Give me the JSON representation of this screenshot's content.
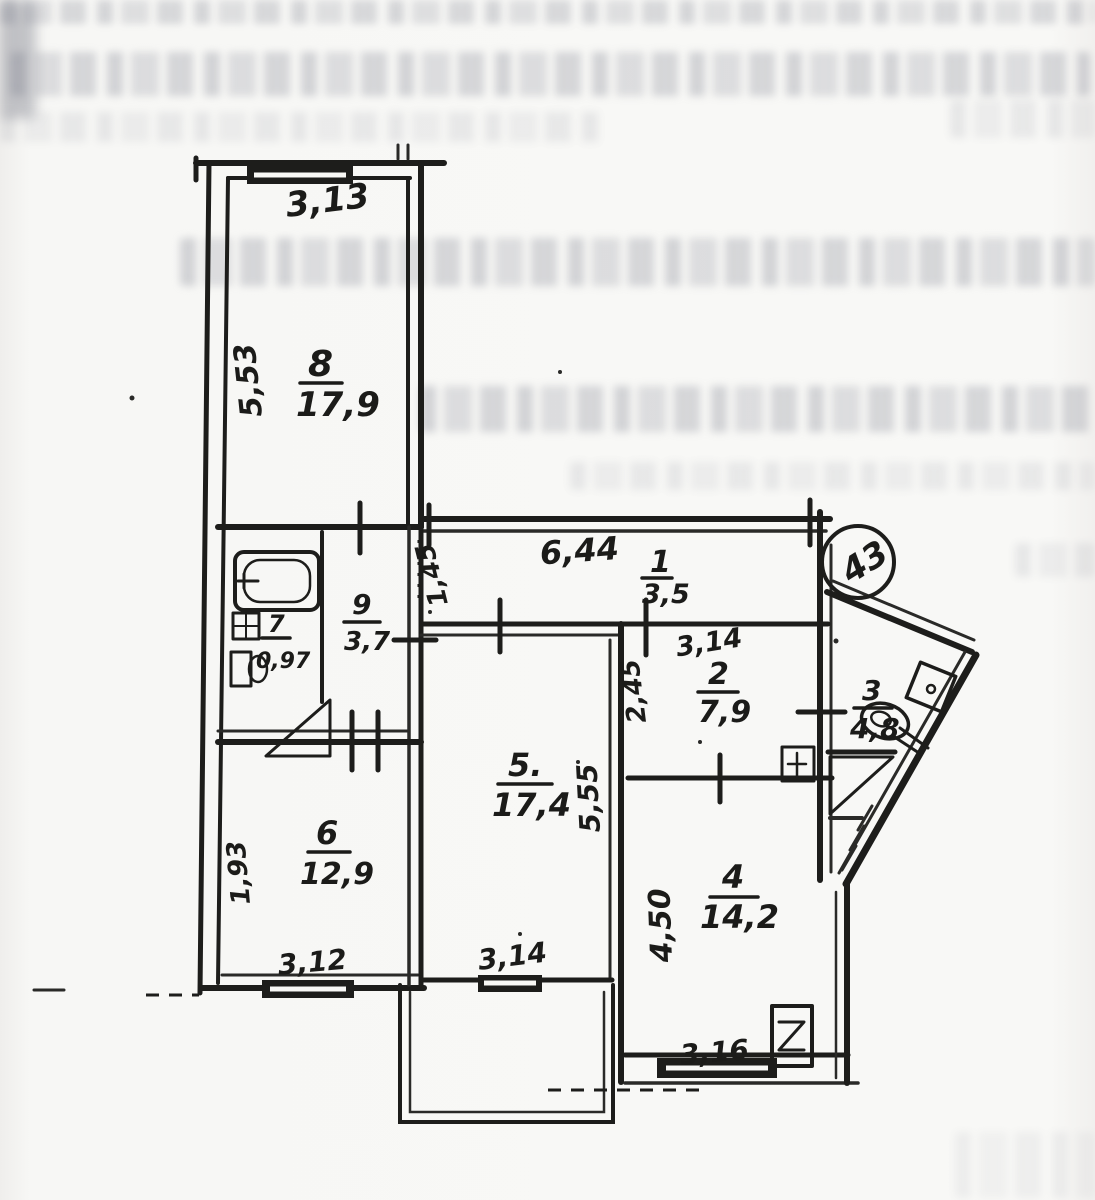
{
  "scan": {
    "apartment_number": "43",
    "rooms": {
      "r1": {
        "num": "1",
        "area": "3,5"
      },
      "r2": {
        "num": "2",
        "area": "7,9"
      },
      "r3": {
        "num": "3",
        "area": "4,8"
      },
      "r4": {
        "num": "4",
        "area": "14,2"
      },
      "r5": {
        "num": "5.",
        "area": "17,4"
      },
      "r6": {
        "num": "6",
        "area": "12,9"
      },
      "r7": {
        "num": "7",
        "area": "0,97"
      },
      "r8": {
        "num": "8",
        "area": "17,9"
      },
      "r9": {
        "num": "9",
        "area": "3,7"
      }
    },
    "dimensions": {
      "win_top_r8": "3,13",
      "left_r8": "5,53",
      "hall_width": "6,44",
      "door_hall": "1,45",
      "corr_height": "2,45",
      "r5_height": "5,55",
      "r2_width": "3,14",
      "r4_height": "4,50",
      "r6_left": "1,93",
      "win_r6": "3,12",
      "win_r5": "3,14",
      "win_r4": "3,16"
    }
  }
}
